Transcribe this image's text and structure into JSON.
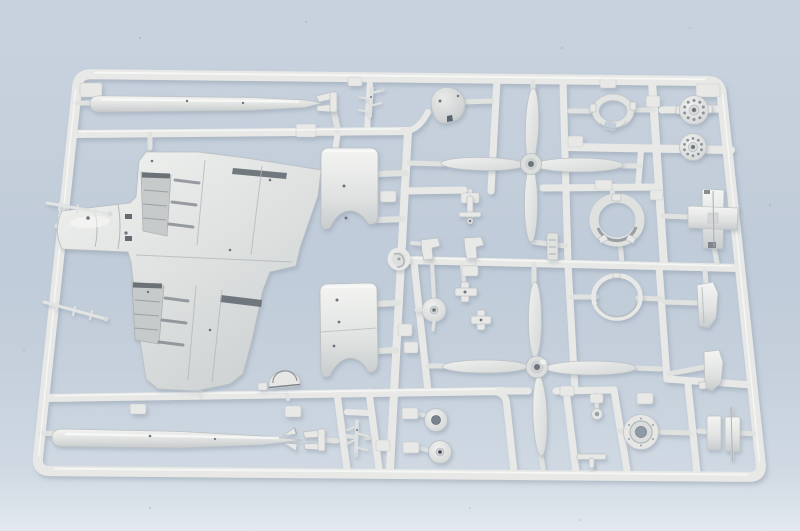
{
  "meta": {
    "type": "photograph",
    "subject": "injection-molded plastic model kit sprue with aircraft parts",
    "orientation": "landscape",
    "text_visible": "none"
  },
  "colors": {
    "background": "#c2cdda",
    "background-bottom": "#e2e8ee",
    "plastic": "#e8e9e7",
    "plastic-dim": "#e0e2e0",
    "plastic-highlight": "#fafbf9",
    "plastic-edge": "#bcc1c4",
    "recess": "#c6cacb",
    "hole-dark": "#6d747b",
    "photo-shadow": "#7e8c9b"
  },
  "sprue": {
    "material": "light gray polystyrene",
    "frame_shape": "rounded rectangle, slight perspective (wider at bottom)",
    "surface": "pale blue tabletop"
  },
  "parts": [
    {
      "id": "drop-tank-upper",
      "desc": "long torpedo-shaped external fuel tank, top row"
    },
    {
      "id": "drop-tank-lower",
      "desc": "long torpedo-shaped external fuel tank with tail fins, bottom row"
    },
    {
      "id": "lower-wing",
      "desc": "one-piece lower wing with center fuselage tube and two wheel-well cutouts"
    },
    {
      "id": "cowling-half-upper",
      "desc": "curved engine cowling panel, upper center"
    },
    {
      "id": "cowling-half-lower",
      "desc": "curved engine cowling panel, lower center"
    },
    {
      "id": "spinner-cone",
      "desc": "propeller spinner dome"
    },
    {
      "id": "propeller-upper",
      "desc": "four-blade propeller, upper"
    },
    {
      "id": "propeller-lower",
      "desc": "four-blade propeller, lower"
    },
    {
      "id": "cowl-ring-notched",
      "desc": "notched engine ring, top right"
    },
    {
      "id": "cowling-ring-deep",
      "desc": "deep cowling ring, middle right"
    },
    {
      "id": "cowl-ring-thin",
      "desc": "thin cowl front ring, lower middle"
    },
    {
      "id": "crankcase-disc-1",
      "desc": "radial engine crankcase disc with bolt holes"
    },
    {
      "id": "crankcase-disc-2",
      "desc": "radial engine crankcase disc with bolt holes"
    },
    {
      "id": "engine-mount-cross",
      "desc": "cross-shaped engine mount part, right"
    },
    {
      "id": "wheel-hub-housing",
      "desc": "round hub housing with center hole, bottom right"
    },
    {
      "id": "main-wheel-open",
      "desc": "wheel with open hub hole"
    },
    {
      "id": "main-wheel-solid",
      "desc": "wheel with solid hub"
    },
    {
      "id": "small-disc-wheel",
      "desc": "small disc wheel with stem"
    },
    {
      "id": "eyelet-part",
      "desc": "small eyelet ring part"
    },
    {
      "id": "gear-door-1",
      "desc": "landing gear door, right column upper"
    },
    {
      "id": "gear-door-2",
      "desc": "landing gear door, right column middle"
    },
    {
      "id": "gear-door-pair",
      "desc": "paired gear door flaps with pin, bottom right"
    },
    {
      "id": "gear-leg-small",
      "desc": "small branched landing gear leg, top center"
    },
    {
      "id": "rack-cluster",
      "desc": "small branched rack part, bottom center-left"
    },
    {
      "id": "headrest-arch",
      "desc": "arched headrest / windscreen frame part"
    },
    {
      "id": "rod-1",
      "desc": "thin stepped strut rod at left rail"
    },
    {
      "id": "rod-2",
      "desc": "thin stepped strut rod at left rail"
    },
    {
      "id": "cross-small-1",
      "desc": "small plus-shaped part"
    },
    {
      "id": "cross-small-2",
      "desc": "small plus-shaped part"
    },
    {
      "id": "bracket-left",
      "desc": "small angular bracket"
    },
    {
      "id": "bracket-right",
      "desc": "small angular bracket"
    },
    {
      "id": "t-strut-upper",
      "desc": "small T strut with wheel"
    },
    {
      "id": "exhaust-stub",
      "desc": "small notched exhaust stub"
    },
    {
      "id": "t-strut-lower",
      "desc": "small T strut near bottom rail"
    },
    {
      "id": "gate-boss",
      "desc": "round sprue gate boss at runner junction"
    },
    {
      "id": "tank-tail-fork-1",
      "desc": "forked holder at upper tank tail"
    },
    {
      "id": "tank-tail-fork-2",
      "desc": "forked holder at lower tank tail"
    }
  ]
}
